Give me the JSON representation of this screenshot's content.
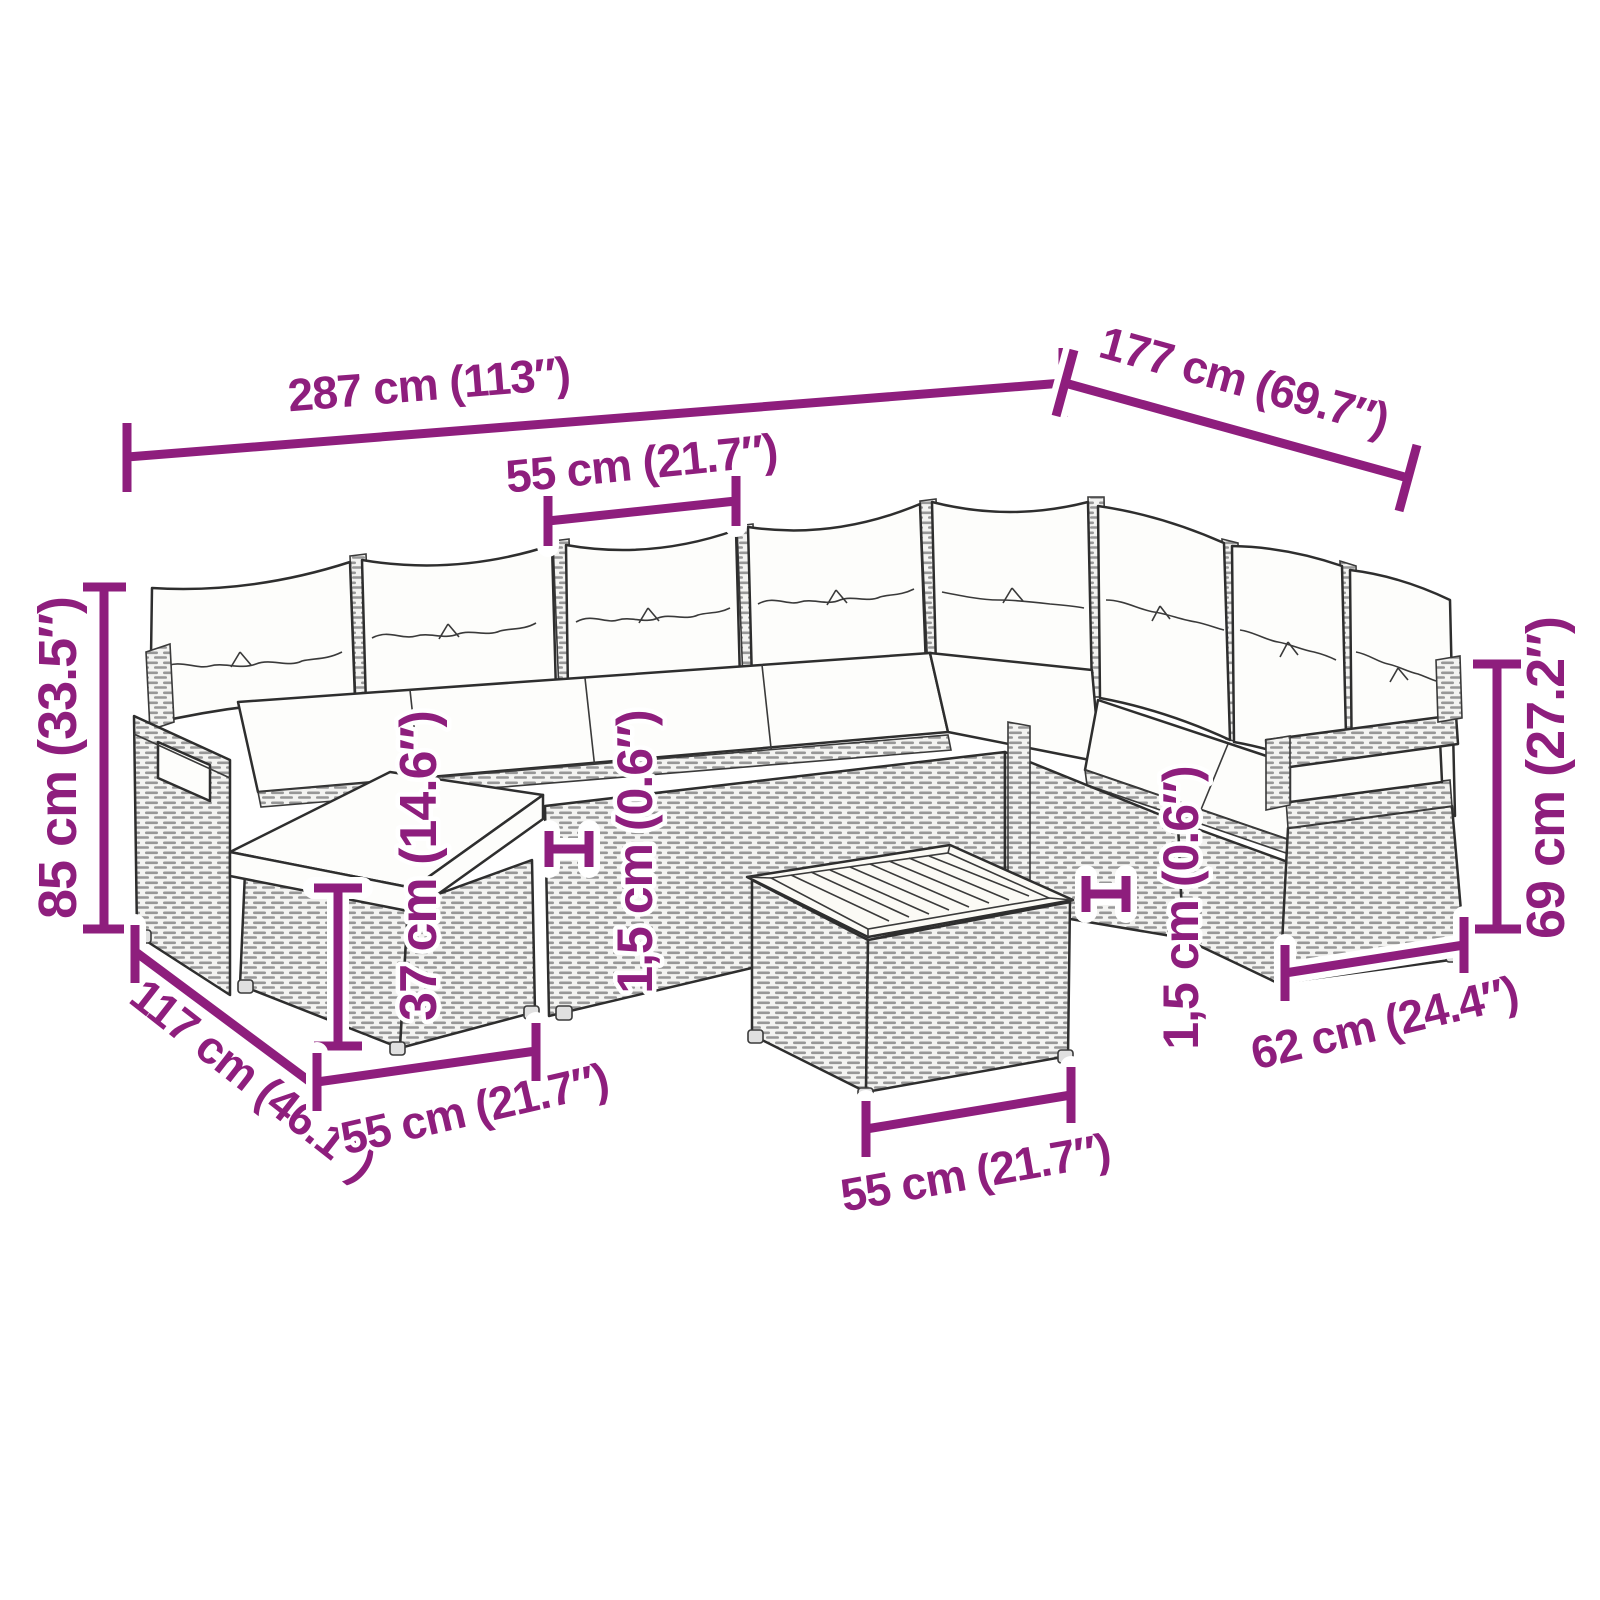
{
  "diagram": {
    "background": "#ffffff",
    "dimension_color": "#8E1E7D",
    "line_art_color": "#2e2e2e",
    "illustration": "rattan-corner-sofa-set-with-cushions-footstool-and-coffee-table",
    "dimensions": {
      "overall_width": "287 cm (113″)",
      "overall_depth": "177 cm (69.7″)",
      "seat_width": "55 cm (21.7″)",
      "overall_height": "85 cm (33.5″)",
      "sofa_depth": "117 cm (46.1″)",
      "footstool_height": "37 cm (14.6″)",
      "cushion_thickness_left": "1,5 cm (0.6″)",
      "footstool_width": "55 cm (21.7″)",
      "table_width": "55 cm (21.7″)",
      "cushion_thickness_right": "1,5 cm (0.6″)",
      "armrest_height": "69 cm (27.2″)",
      "armrest_depth": "62 cm (24.4″)"
    }
  }
}
